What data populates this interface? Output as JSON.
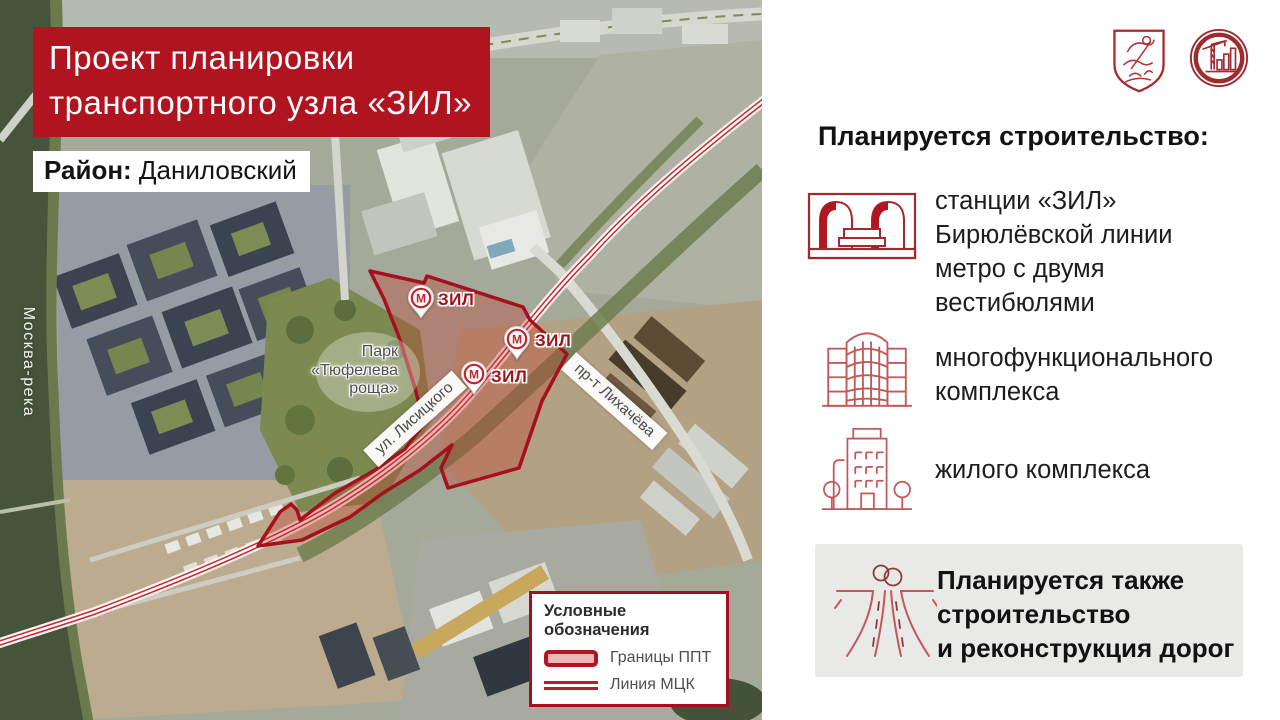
{
  "colors": {
    "accent_red": "#b11421",
    "dark_red": "#a6101e",
    "metro_red": "#c4232e",
    "icon_red": "#c1585a",
    "note_box_gray": "#e9e9e7"
  },
  "map": {
    "title": "Проект планировки\nтранспортного узла «ЗИЛ»",
    "district_label": "Район:",
    "district_value": "Даниловский",
    "river_label": "Москва-река",
    "park_label": "Парк\n«Тюфелева\nроща»",
    "streets": [
      {
        "name": "ул. Лисицкого"
      },
      {
        "name": "пр-т Лихачёва"
      }
    ],
    "metro_letter": "М",
    "markers": [
      {
        "label": "ЗИЛ"
      },
      {
        "label": "ЗИЛ"
      },
      {
        "label": "ЗИЛ"
      }
    ],
    "legend": {
      "title": "Условные обозначения",
      "items": [
        {
          "label": "Границы ППТ"
        },
        {
          "label": "Линия МЦК"
        }
      ]
    }
  },
  "panel": {
    "heading": "Планируется строительство:",
    "items": [
      {
        "icon": "metro-station-icon",
        "text": "станции «ЗИЛ»\nБирюлёвской линии\nметро с двумя\nвестибюлями"
      },
      {
        "icon": "mixed-use-complex-icon",
        "text": "многофункционального\nкомплекса"
      },
      {
        "icon": "residential-complex-icon",
        "text": "жилого комплекса"
      }
    ],
    "note": {
      "icon": "roads-icon",
      "text": "Планируется также\nстроительство\nи реконструкция дорог"
    }
  }
}
